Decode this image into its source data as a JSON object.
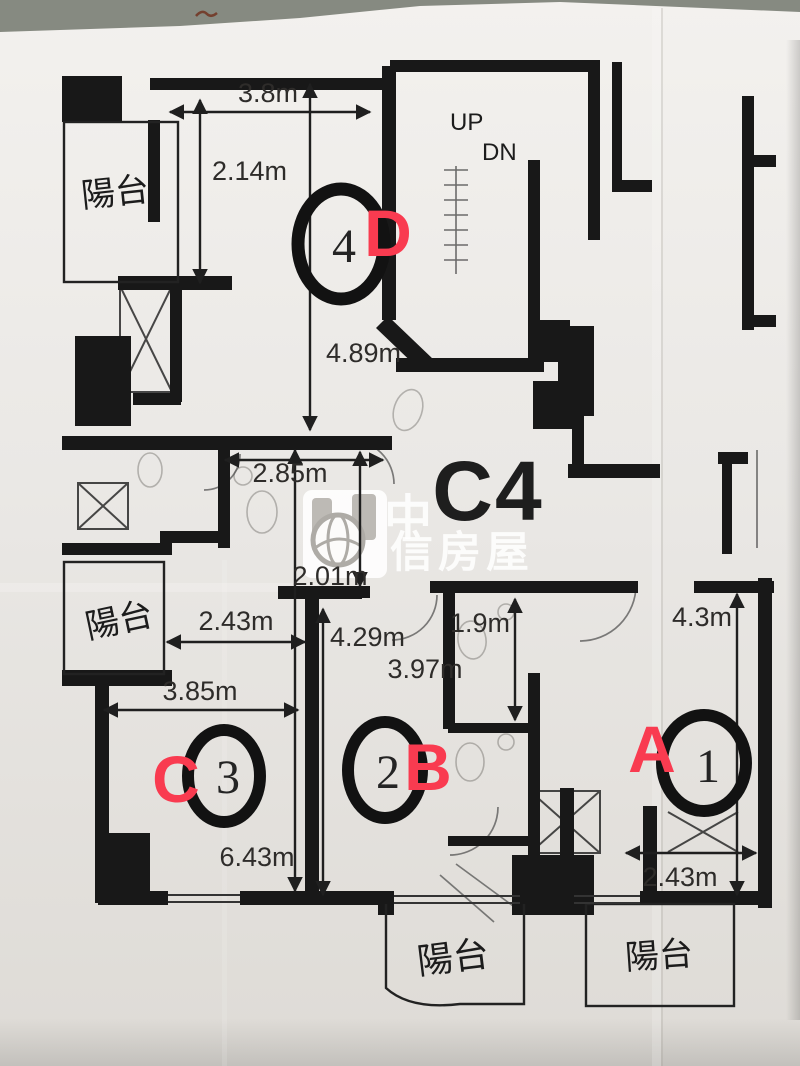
{
  "plan": {
    "code": "C4",
    "balcony_label": "陽台",
    "stairs": {
      "up": "UP",
      "dn": "DN"
    },
    "watermark": {
      "line1": "中",
      "line2": "信房屋"
    }
  },
  "rooms": {
    "a": {
      "letter": "A",
      "number": "1"
    },
    "b": {
      "letter": "B",
      "number": "2"
    },
    "c": {
      "letter": "C",
      "number": "3"
    },
    "d": {
      "letter": "D",
      "number": "4"
    }
  },
  "dimensions": {
    "top_width": "3.8m",
    "balcony_depth": "2.14m",
    "room4_depth": "4.89m",
    "mid_width": "2.85m",
    "hall_width": "2.01m",
    "room3_top_width": "2.43m",
    "room2_height": "4.29m",
    "room2_width": "3.97m",
    "bath_height": "1.9m",
    "room1_height": "4.3m",
    "room3_width": "3.85m",
    "room3_height": "6.43m",
    "room1_width": "2.43m"
  },
  "colors": {
    "marker_red": "#f93b50",
    "ink": "#1f1f1f",
    "paper": "#eceae7"
  }
}
